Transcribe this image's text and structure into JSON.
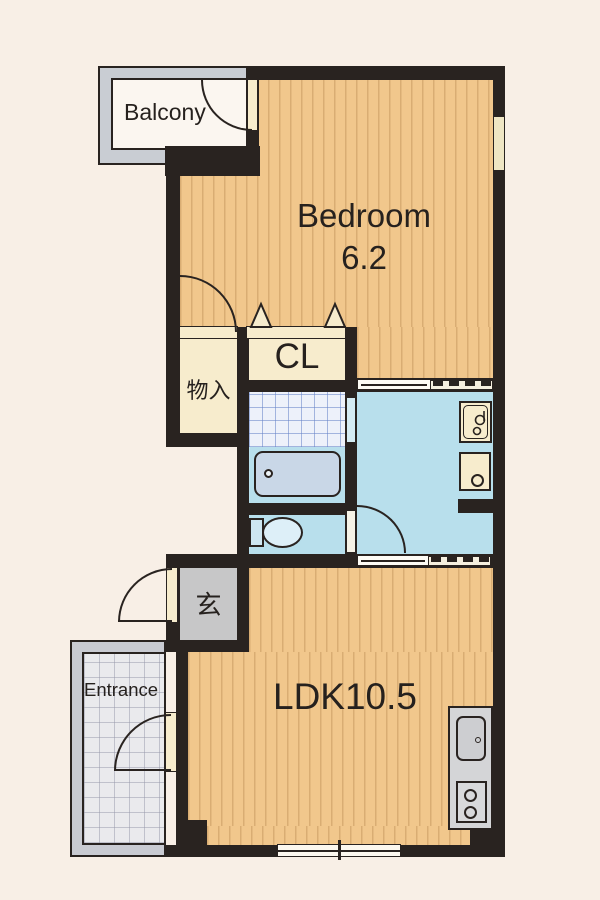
{
  "plan": {
    "type": "apartment-floor-plan",
    "labels": {
      "balcony": "Balcony",
      "bedroom_name": "Bedroom",
      "bedroom_size": "6.2",
      "closet": "CL",
      "storage": "物入",
      "genkan": "玄",
      "entrance": "Entrance",
      "ldk": "LDK10.5"
    },
    "colors": {
      "background": "#f8efe6",
      "wall": "#292320",
      "wood_floor": "#f1c78c",
      "cream_fixture": "#f7eccd",
      "water_area": "#b8dfec",
      "bath_tile": "#edf1fa",
      "bathtub": "#c9d7e7",
      "gray_area": "#c7c7c8",
      "kitchen_counter": "#d4d5d7",
      "balcony_frame": "#c9cdd3",
      "porch_tile": "#eaeaed"
    },
    "fixtures": [
      "bathtub",
      "toilet",
      "washbasin",
      "washing-machine-pan",
      "kitchen-sink",
      "gas-stove",
      "closet-folding-doors",
      "balcony-door",
      "storage-door",
      "toilet-door",
      "entrance-door",
      "bedroom-sliding-door",
      "ldk-sliding-door",
      "bedroom-window",
      "ldk-window"
    ]
  }
}
